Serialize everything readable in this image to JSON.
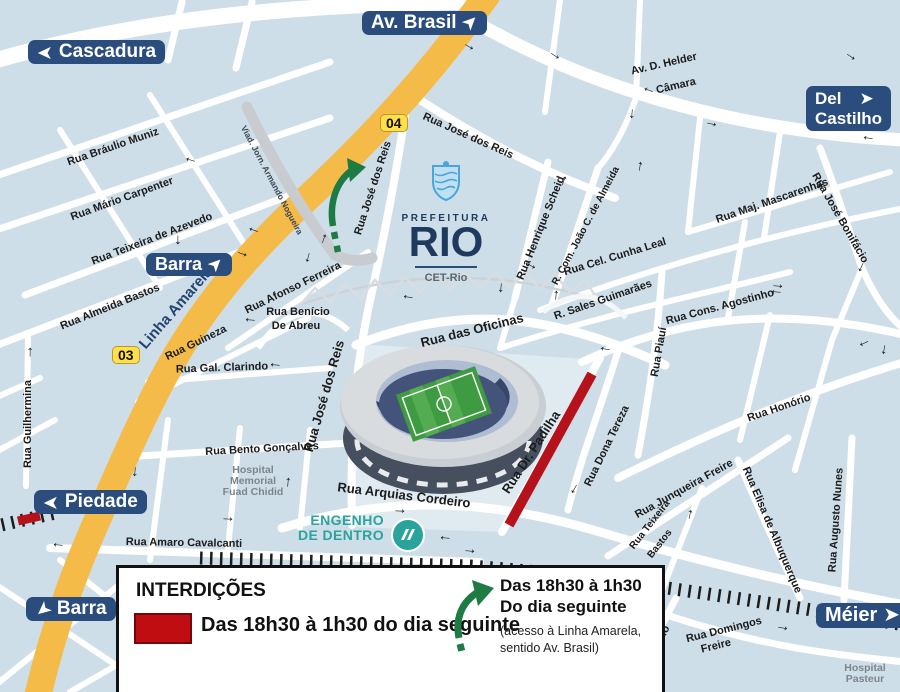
{
  "signs": {
    "cascadura": "Cascadura",
    "av_brasil": "Av. Brasil",
    "del_castilho_line1": "Del",
    "del_castilho_line2": "Castilho",
    "barra_mid": "Barra",
    "piedade": "Piedade",
    "barra_bottom": "Barra",
    "meier": "Méier"
  },
  "shields": {
    "s04": "04",
    "s03": "03"
  },
  "logo": {
    "prefeitura": "PREFEITURA",
    "rio": "RIO",
    "cet": "CET-Rio"
  },
  "station": {
    "name_line1": "ENGENHO",
    "name_line2": "DE DENTRO"
  },
  "streets": [
    {
      "label": "Rua Bráulio Muniz"
    },
    {
      "label": "Rua Mário Carpenter"
    },
    {
      "label": "Rua Teixeira de Azevedo"
    },
    {
      "label": "Rua Almeida Bastos"
    },
    {
      "label": "Viad. Jorn. Armando Nogueira"
    },
    {
      "label": "Rua José dos Reis"
    },
    {
      "label": "Rua José dos Reis"
    },
    {
      "label": "Rua José dos Reis"
    },
    {
      "label": "Av. D. Helder"
    },
    {
      "label": "Câmara"
    },
    {
      "label": "Rua Henrique Scheid"
    },
    {
      "label": "R. Com. João C. de Almeida"
    },
    {
      "label": "Rua Cel. Cunha Leal"
    },
    {
      "label": "R. Sales Guimarães"
    },
    {
      "label": "Rua Maj. Mascarenhas"
    },
    {
      "label": "Rua José Bonifácio"
    },
    {
      "label": "Rua Cons. Agostinho"
    },
    {
      "label": "Rua Piauí"
    },
    {
      "label": "Rua Honório"
    },
    {
      "label": "Rua Dona Tereza"
    },
    {
      "label": "Rua das Oficinas"
    },
    {
      "label": "Rua Dr. Padilha"
    },
    {
      "label": "Rua Arquias Cordeiro"
    },
    {
      "label": "Rua Guineza"
    },
    {
      "label": "Rua Afonso Ferreira"
    },
    {
      "label": "Rua Benício"
    },
    {
      "label": "De Abreu"
    },
    {
      "label": "Rua Gal. Clarindo"
    },
    {
      "label": "Rua Bento Gonçalves"
    },
    {
      "label": "Rua Amaro Cavalcanti"
    },
    {
      "label": "Rua Guilhermina"
    },
    {
      "label": "Linha Amarela"
    },
    {
      "label": "Rua Junqueira Freire"
    },
    {
      "label": "Rua Teixeira"
    },
    {
      "label": "Bastos"
    },
    {
      "label": "Rua Elisa de Albuquerque"
    },
    {
      "label": "Rua Augusto Nunes"
    },
    {
      "label": "Rua Adriano"
    },
    {
      "label": "Rua Domingos"
    },
    {
      "label": "Freire"
    }
  ],
  "hospitals": {
    "fuad": [
      "Hospital",
      "Memorial",
      "Fuad Chidid"
    ],
    "pasteur": [
      "Hospital",
      "Pasteur"
    ]
  },
  "legend": {
    "title": "INTERDIÇÕES",
    "closed_label": "Das 18h30 à 1h30 do dia seguinte",
    "green_label_line1": "Das 18h30 à 1h30",
    "green_label_line2": "Do dia seguinte",
    "green_note_line1": "(acesso à Linha Amarela,",
    "green_note_line2": "sentido Av. Brasil)"
  },
  "icons": {
    "arrow": "→",
    "sign_arrow": "➤"
  },
  "colors": {
    "map_bg": "#cedee8",
    "sign_bg": "#2b4d7d",
    "linha_amarela_yellow": "#f5bb49",
    "closure_red": "#b5121b",
    "access_green": "#1e7b44",
    "station_teal": "#2ba39d"
  }
}
